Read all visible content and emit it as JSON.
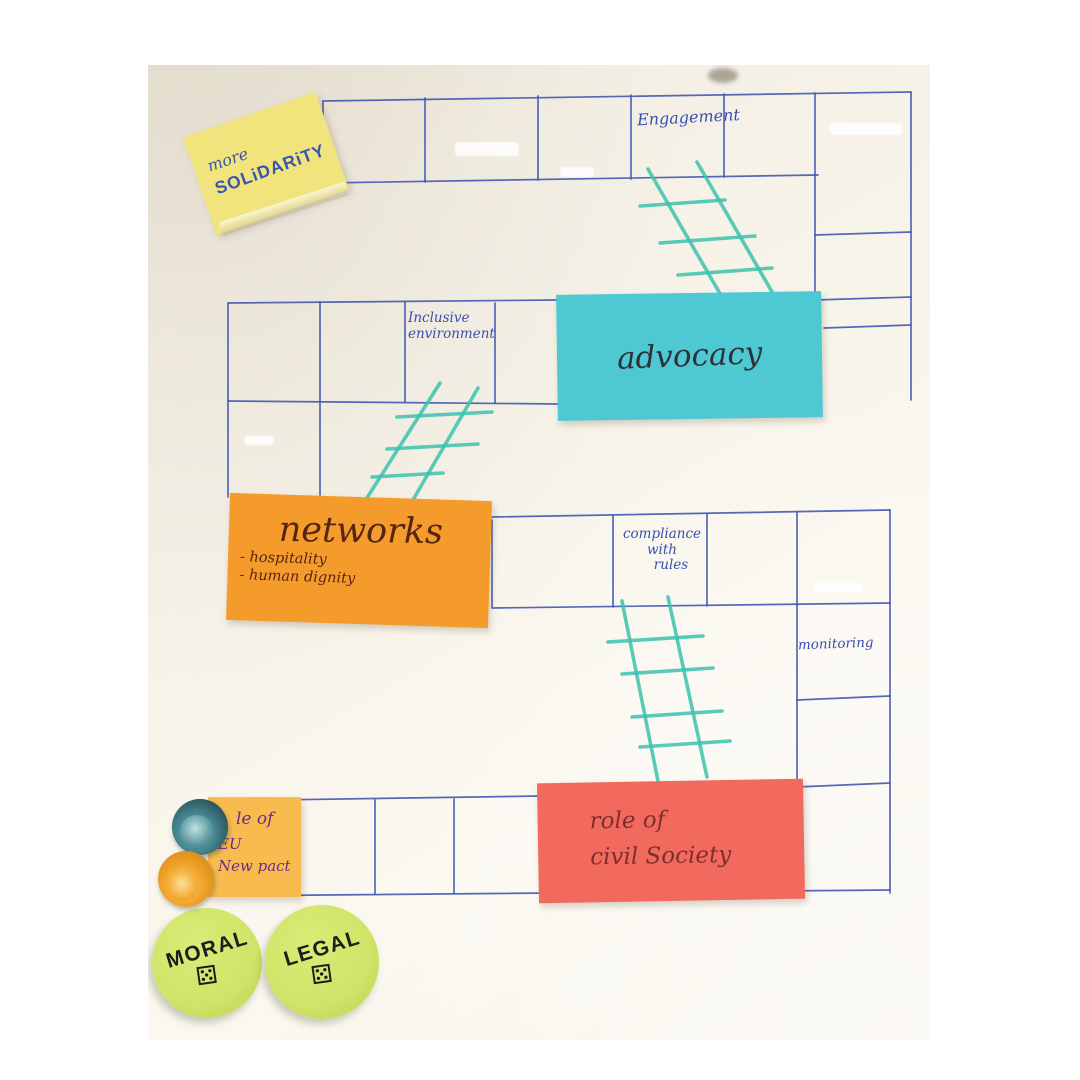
{
  "board": {
    "cell_labels": {
      "engagement": "Engagement",
      "inclusive_line1": "Inclusive",
      "inclusive_line2": "environment",
      "compliance_line1": "compliance",
      "compliance_line2": "with",
      "compliance_line3": "rules",
      "monitoring": "monitoring"
    },
    "grid_ink_color": "#3f55b0",
    "ladder_color": "#3cc3ae",
    "ladder_count": 3
  },
  "stickies": {
    "solidarity": {
      "line1": "more",
      "line2": "SOLiDARiTY",
      "color": "#f1e47c",
      "ink": "#3a55b0"
    },
    "advocacy": {
      "label": "advocacy",
      "color": "#4ec9d4",
      "ink": "#2e3238"
    },
    "networks": {
      "title": "networks",
      "bullet1": "- hospitality",
      "bullet2": "- human dignity",
      "color": "#f59b2c",
      "ink": "#552510"
    },
    "civil_society": {
      "line1": "role of",
      "line2": "civil Society",
      "color": "#f26a5e",
      "ink": "#7e2f2a"
    },
    "eu_new_pact": {
      "line1": "le of",
      "line2": "EU",
      "line3": "New pact",
      "color": "#f7bb4f",
      "ink": "#6b2d86"
    }
  },
  "tokens": {
    "moral": "MORAL",
    "legal": "LEGAL",
    "die_glyph": "⚄",
    "circle_color": "#cfe468"
  },
  "magnets": {
    "teal": "#4a8e99",
    "orange": "#f0a32a"
  }
}
